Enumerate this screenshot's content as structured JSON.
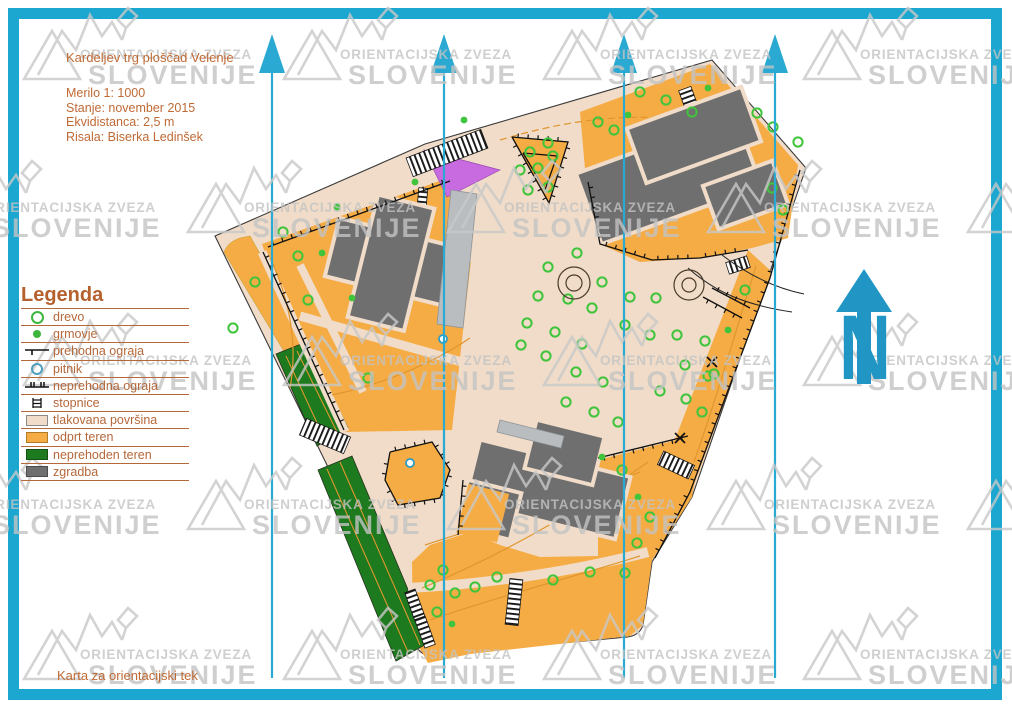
{
  "header": {
    "title": "Kardeljev trg ploščad Velenje",
    "scale": "Merilo 1: 1000",
    "status": "Stanje: november 2015",
    "equidistance": "Ekvidistanca: 2,5 m",
    "author": "Risala: Biserka Ledinšek"
  },
  "footer": {
    "caption": "Karta za orientacijski tek"
  },
  "legend": {
    "title": "Legenda",
    "items": [
      {
        "label": "drevo",
        "symbol": "tree"
      },
      {
        "label": "grmovje",
        "symbol": "bush"
      },
      {
        "label": "prehodna ograja",
        "symbol": "passable-fence"
      },
      {
        "label": "pitnik",
        "symbol": "drinking-fountain"
      },
      {
        "label": "neprehodna ograja",
        "symbol": "impassable-fence"
      },
      {
        "label": "stopnice",
        "symbol": "stairs"
      },
      {
        "label": "tlakovana površina",
        "symbol": "paved-area"
      },
      {
        "label": "odprt teren",
        "symbol": "open-terrain"
      },
      {
        "label": "neprehoden teren",
        "symbol": "impassable-terrain"
      },
      {
        "label": "zgradba",
        "symbol": "building"
      }
    ]
  },
  "watermark": {
    "line1": "ORIENTACIJSKA ZVEZA",
    "line2": "SLOVENIJE",
    "positions": [
      [
        18,
        5
      ],
      [
        278,
        5
      ],
      [
        538,
        5
      ],
      [
        798,
        5
      ],
      [
        -78,
        158
      ],
      [
        182,
        158
      ],
      [
        442,
        158
      ],
      [
        702,
        158
      ],
      [
        962,
        158
      ],
      [
        18,
        311
      ],
      [
        278,
        311
      ],
      [
        538,
        311
      ],
      [
        798,
        311
      ],
      [
        -78,
        455
      ],
      [
        182,
        455
      ],
      [
        442,
        455
      ],
      [
        702,
        455
      ],
      [
        962,
        455
      ],
      [
        18,
        605
      ],
      [
        278,
        605
      ],
      [
        538,
        605
      ],
      [
        798,
        605
      ]
    ]
  },
  "north_arrow": {
    "label": "N"
  },
  "colors": {
    "frame_cyan": "#1ba7cf",
    "line_cyan": "#2aa9d2",
    "map_beige": "#f0dcc8",
    "map_orange": "#f6ac44",
    "map_dark_green": "#1e7a1e",
    "building_gray": "#6f6f6f",
    "canopy_gray": "#b9bdc0",
    "forbidden_purple": "#c86ae0",
    "tree_green": "#3fc43c",
    "text_brown": "#bf6a35",
    "watermark_gray": "#c6c6c6"
  },
  "map": {
    "north_line_xs": [
      272,
      444,
      624,
      775
    ],
    "north_line_top": 34,
    "north_line_bottom": 678,
    "trees": [
      [
        283,
        232
      ],
      [
        255,
        282
      ],
      [
        233,
        328
      ],
      [
        298,
        256
      ],
      [
        308,
        300
      ],
      [
        368,
        378
      ],
      [
        530,
        152
      ],
      [
        548,
        143
      ],
      [
        553,
        156
      ],
      [
        538,
        168
      ],
      [
        548,
        187
      ],
      [
        528,
        190
      ],
      [
        520,
        170
      ],
      [
        640,
        92
      ],
      [
        666,
        100
      ],
      [
        692,
        112
      ],
      [
        598,
        122
      ],
      [
        614,
        130
      ],
      [
        757,
        113
      ],
      [
        773,
        127
      ],
      [
        798,
        142
      ],
      [
        772,
        188
      ],
      [
        783,
        210
      ],
      [
        745,
        290
      ],
      [
        714,
        374
      ],
      [
        702,
        412
      ],
      [
        577,
        253
      ],
      [
        548,
        267
      ],
      [
        602,
        282
      ],
      [
        538,
        296
      ],
      [
        568,
        299
      ],
      [
        592,
        308
      ],
      [
        630,
        297
      ],
      [
        656,
        298
      ],
      [
        527,
        323
      ],
      [
        555,
        332
      ],
      [
        582,
        344
      ],
      [
        521,
        345
      ],
      [
        546,
        356
      ],
      [
        625,
        325
      ],
      [
        650,
        335
      ],
      [
        677,
        335
      ],
      [
        705,
        341
      ],
      [
        576,
        372
      ],
      [
        603,
        382
      ],
      [
        685,
        365
      ],
      [
        708,
        376
      ],
      [
        660,
        391
      ],
      [
        686,
        399
      ],
      [
        566,
        402
      ],
      [
        594,
        412
      ],
      [
        618,
        422
      ],
      [
        622,
        470
      ],
      [
        650,
        517
      ],
      [
        637,
        543
      ],
      [
        625,
        573
      ],
      [
        590,
        572
      ],
      [
        553,
        580
      ],
      [
        497,
        577
      ],
      [
        443,
        570
      ],
      [
        430,
        585
      ],
      [
        455,
        593
      ],
      [
        475,
        587
      ],
      [
        437,
        612
      ]
    ],
    "bushes": [
      [
        337,
        207
      ],
      [
        322,
        253
      ],
      [
        415,
        182
      ],
      [
        464,
        120
      ],
      [
        708,
        88
      ],
      [
        628,
        115
      ],
      [
        352,
        298
      ],
      [
        638,
        497
      ],
      [
        452,
        624
      ],
      [
        728,
        330
      ],
      [
        602,
        457
      ]
    ],
    "fountains": [
      {
        "cx": 574,
        "cy": 283,
        "r_outer": 16,
        "r_inner": 8
      },
      {
        "cx": 689,
        "cy": 285,
        "r_outer": 15,
        "r_inner": 7
      }
    ],
    "x_marks": [
      [
        712,
        362
      ],
      [
        680,
        438
      ]
    ],
    "drinking_fountains_on_map": [
      [
        410,
        463
      ],
      [
        443,
        339
      ]
    ]
  }
}
